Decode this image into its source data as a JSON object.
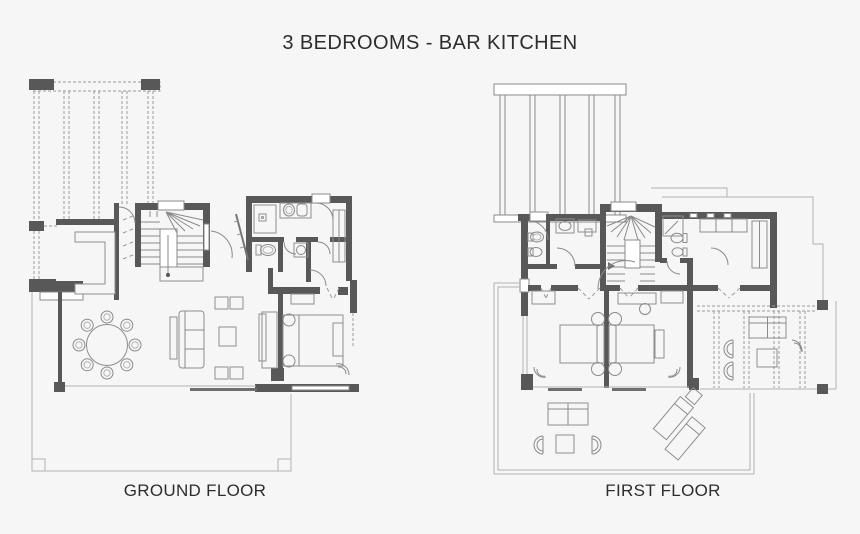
{
  "title": "3 BEDROOMS - BAR KITCHEN",
  "plans": [
    {
      "label": "GROUND FLOOR"
    },
    {
      "label": "FIRST FLOOR"
    }
  ],
  "colors": {
    "background": "#f6f6f6",
    "wall": "#585858",
    "line": "#8a8a8a",
    "thin_line": "#b3b3b3",
    "furniture_line": "#8e8e8e",
    "text": "#2d2d2d",
    "white": "#ffffff"
  }
}
